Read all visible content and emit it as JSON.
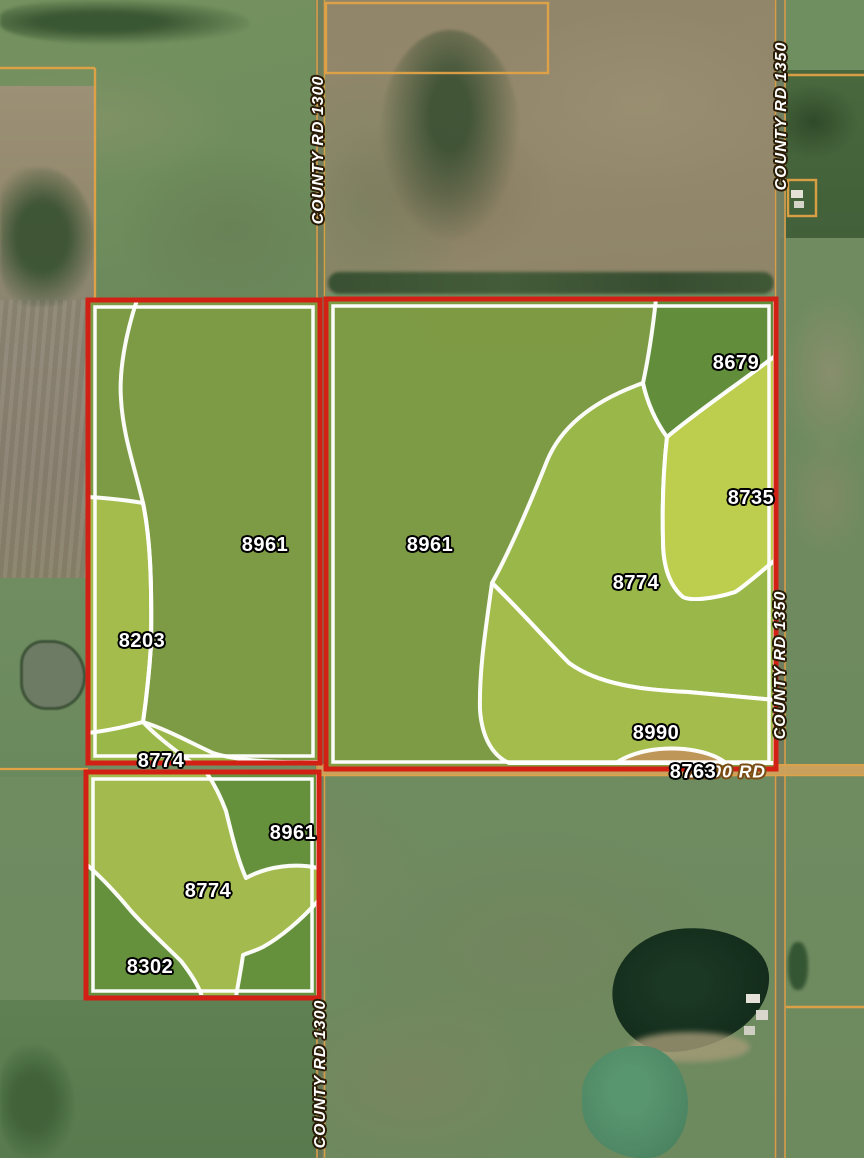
{
  "road_labels": [
    {
      "id": "county-rd-1300-top",
      "text": "COUNTY RD 1300",
      "x": 319,
      "y": 150,
      "rotate": -90
    },
    {
      "id": "county-rd-1350-top",
      "text": "COUNTY RD 1350",
      "x": 782,
      "y": 116,
      "rotate": -90
    },
    {
      "id": "county-rd-1350-mid",
      "text": "COUNTY RD 1350",
      "x": 781,
      "y": 665,
      "rotate": -90
    },
    {
      "id": "county-rd-1300-bottom",
      "text": "COUNTY RD 1300",
      "x": 321,
      "y": 1074,
      "rotate": -90
    },
    {
      "id": "rd-2800",
      "text": "2800 RD",
      "x": 728,
      "y": 772,
      "rotate": 0
    }
  ],
  "soil_labels": [
    {
      "id": "p1-8961",
      "text": "8961",
      "x": 265,
      "y": 545
    },
    {
      "id": "p1-8203",
      "text": "8203",
      "x": 142,
      "y": 641
    },
    {
      "id": "p1-8774",
      "text": "8774",
      "x": 161,
      "y": 761
    },
    {
      "id": "p2-8961",
      "text": "8961",
      "x": 430,
      "y": 545
    },
    {
      "id": "p2-8679",
      "text": "8679",
      "x": 736,
      "y": 363
    },
    {
      "id": "p2-8735",
      "text": "8735",
      "x": 751,
      "y": 498
    },
    {
      "id": "p2-8774",
      "text": "8774",
      "x": 636,
      "y": 583
    },
    {
      "id": "p2-8990",
      "text": "8990",
      "x": 656,
      "y": 733
    },
    {
      "id": "p2-8763",
      "text": "8763",
      "x": 693,
      "y": 772
    },
    {
      "id": "p3-8961",
      "text": "8961",
      "x": 293,
      "y": 833
    },
    {
      "id": "p3-8774",
      "text": "8774",
      "x": 208,
      "y": 891
    },
    {
      "id": "p3-8302",
      "text": "8302",
      "x": 150,
      "y": 967
    }
  ],
  "colors": {
    "parcel_border": "#d32015",
    "zone_boundary": "#ffffff",
    "road_line": "#e2a246",
    "road_surface": "#cfa25c",
    "zone_olive": "#7e9c40",
    "zone_light": "#a9c04d",
    "zone_mid": "#9dbb4b",
    "zone_yellow": "#c4d350",
    "zone_dark": "#5f8d3b",
    "zone_tan": "#c0915a"
  }
}
